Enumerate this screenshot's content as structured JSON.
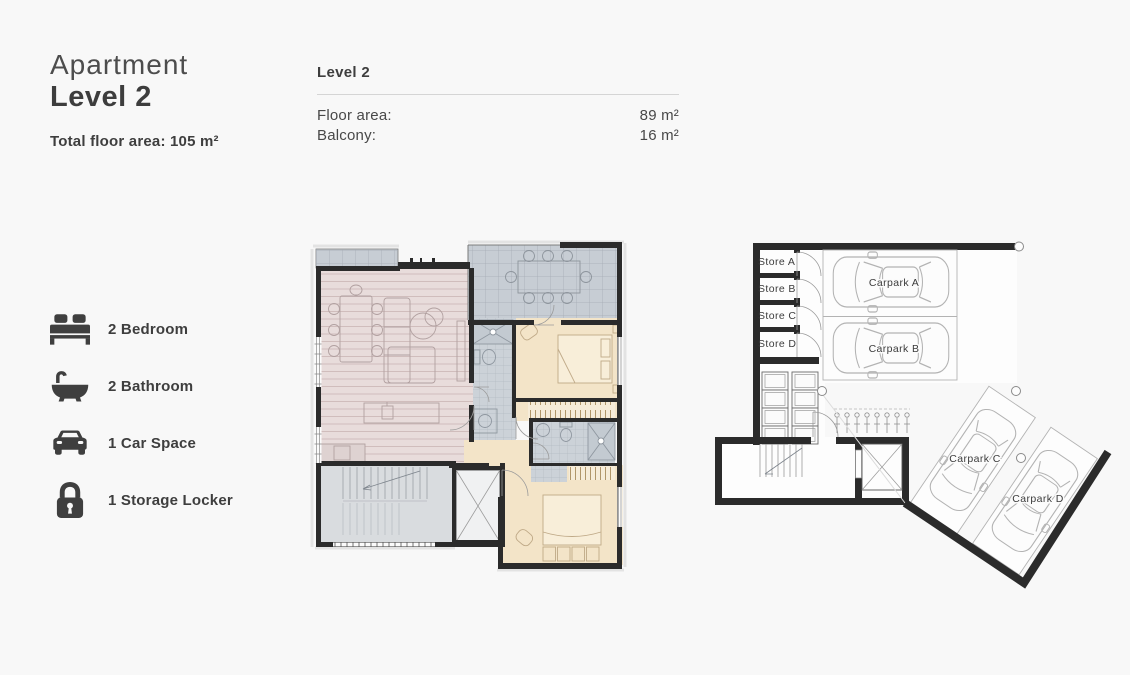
{
  "header": {
    "title_top": "Apartment",
    "title_bottom": "Level 2",
    "total_area": "Total floor area: 105 m²"
  },
  "details": {
    "heading": "Level 2",
    "rows": [
      {
        "label": "Floor area:",
        "value": "89 m²"
      },
      {
        "label": "Balcony:",
        "value": "16 m²"
      }
    ]
  },
  "features": [
    {
      "icon": "bed-icon",
      "label": "2 Bedroom"
    },
    {
      "icon": "bath-icon",
      "label": "2 Bathroom"
    },
    {
      "icon": "car-icon",
      "label": "1 Car Space"
    },
    {
      "icon": "lock-icon",
      "label": "1 Storage Locker"
    }
  ],
  "carpark_plan": {
    "store_labels": [
      "Store A",
      "Store B",
      "Store C",
      "Store D"
    ],
    "carpark_labels": [
      "Carpark A",
      "Carpark B",
      "Carpark C",
      "Carpark D"
    ]
  },
  "colors": {
    "background": "#f8f8f8",
    "text_dark": "#3e3e3e",
    "wall": "#2b2b2b",
    "living_floor": "#e8dcdb",
    "bedroom_floor": "#f3e4c8",
    "balcony_floor": "#c7cdd4",
    "bathroom_floor": "#ccd2d8",
    "stairs_floor": "#d9dcdf"
  }
}
